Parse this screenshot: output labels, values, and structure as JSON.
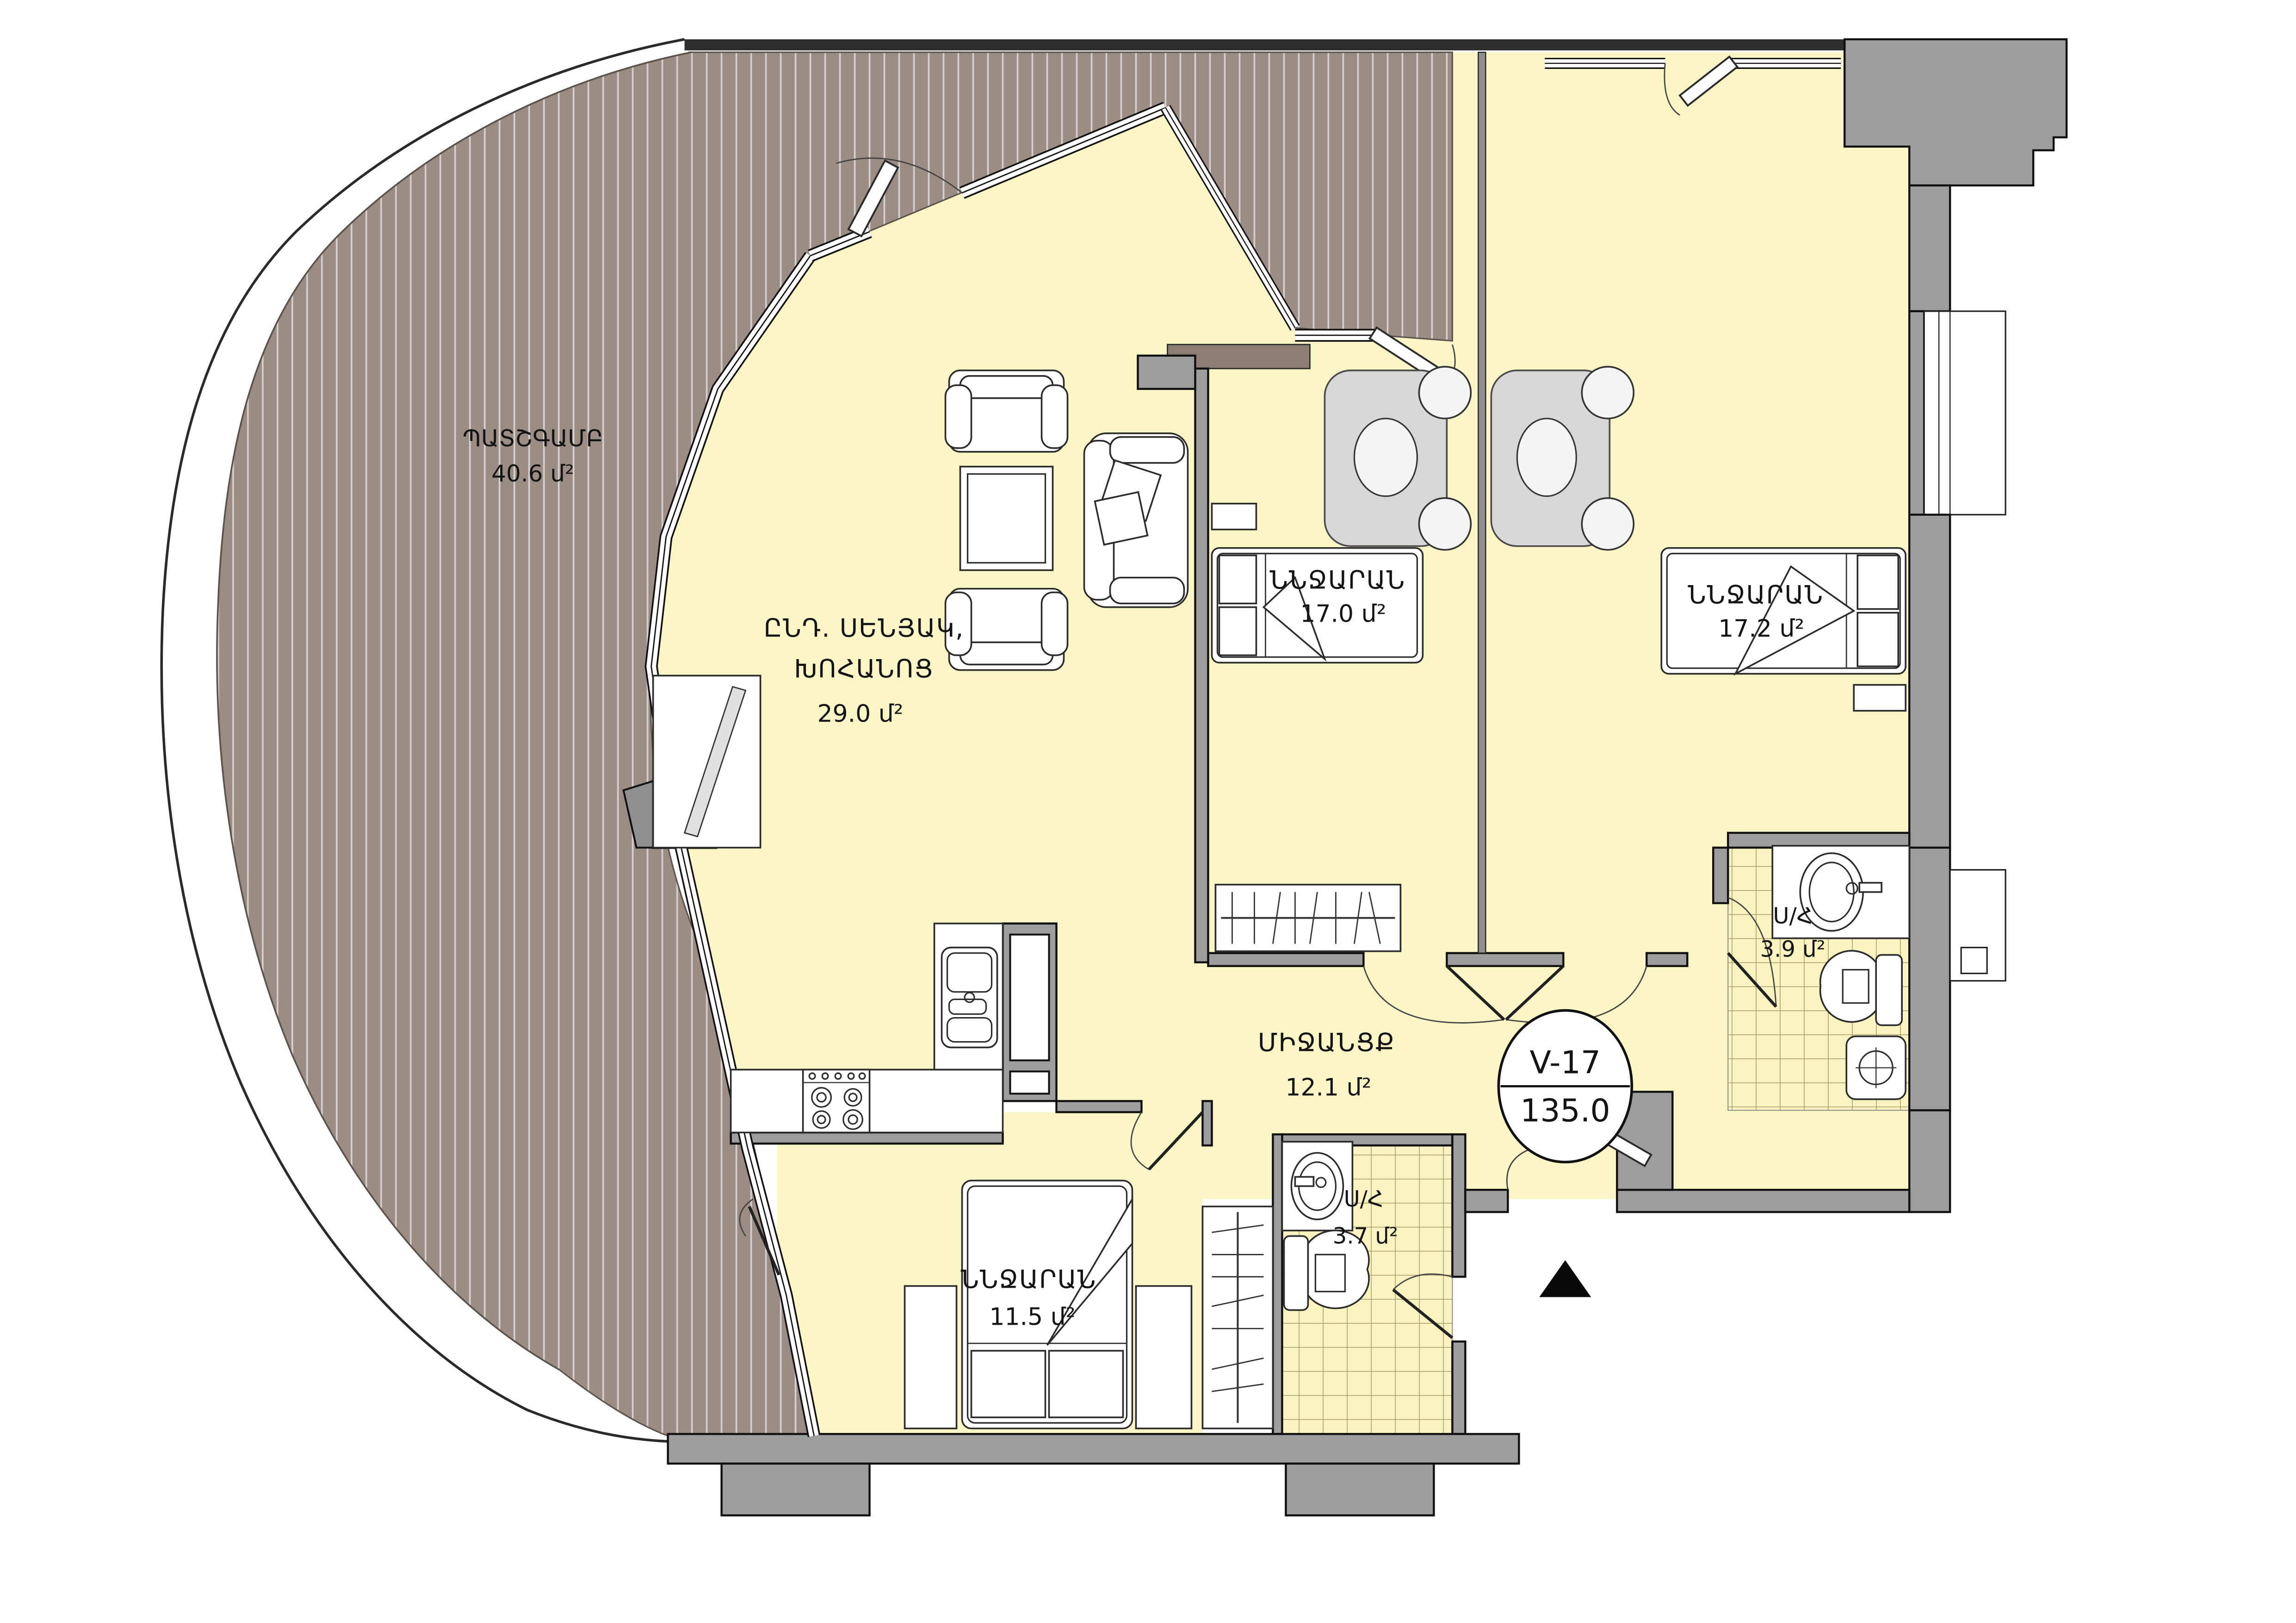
{
  "plan": {
    "unit_stamp": {
      "code": "V-17",
      "total_area": "135.0"
    },
    "rooms": {
      "balcony": {
        "name": "ՊԱՏՇԳԱՄԲ",
        "area": "40.6 մ²"
      },
      "living": {
        "name_line1": "ԸՆԴ. ՍԵՆՅԱԿ,",
        "name_line2": "ԽՈՀԱՆՈՑ",
        "area": "29.0 մ²"
      },
      "bedroom1": {
        "name": "ՆՆՋԱՐԱՆ",
        "area": "17.0 մ²"
      },
      "bedroom2": {
        "name": "ՆՆՋԱՐԱՆ",
        "area": "17.2 մ²"
      },
      "bedroom3": {
        "name": "ՆՆՋԱՐԱՆ",
        "area": "11.5 մ²"
      },
      "hall": {
        "name": "ՄԻՋԱՆՑՔ",
        "area": "12.1 մ²"
      },
      "bath1": {
        "name": "Ս/Հ",
        "area": "3.9 մ²"
      },
      "bath2": {
        "name": "Ս/Հ",
        "area": "3.7 մ²"
      }
    },
    "colors": {
      "room_fill": "#FBF5C5",
      "balcony_fill": "#9C8D84",
      "wall_gray": "#9D9D9D",
      "table_gray": "#D7D7D7",
      "outline": "#000000"
    }
  }
}
